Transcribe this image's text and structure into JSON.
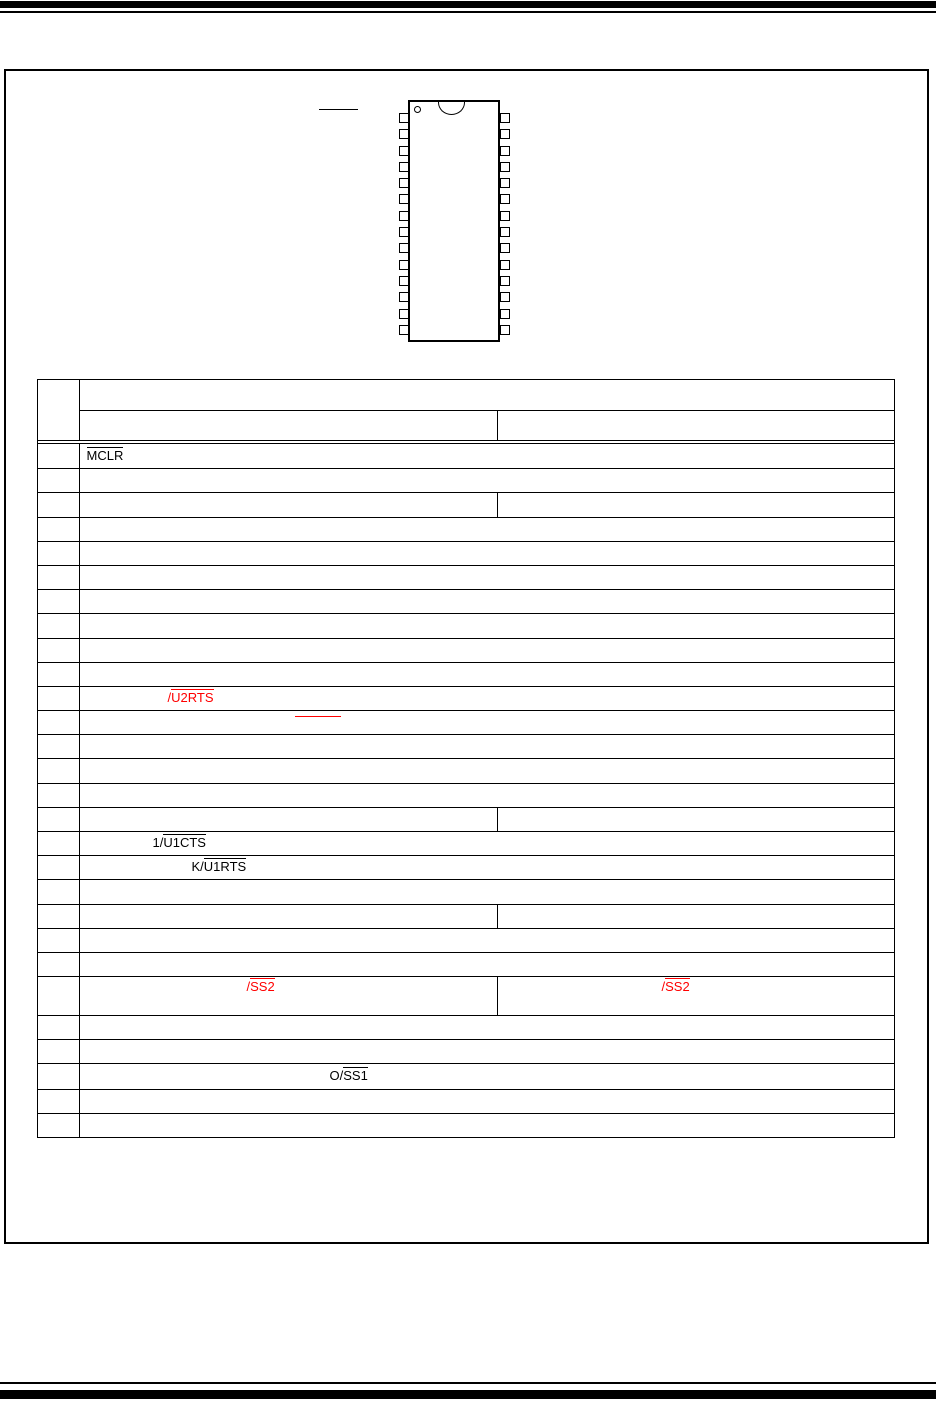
{
  "colors": {
    "line_black": "#000000",
    "highlight_red": "#ff0000",
    "page_background": "#ffffff"
  },
  "chip": {
    "package_pin_count": 28,
    "pins_per_side": 14
  },
  "pin_table": {
    "labels": {
      "mclr": {
        "pre": "",
        "over": "MCLR"
      },
      "u2rts": {
        "pre": "/",
        "over": "U2RTS"
      },
      "u1cts": {
        "pre": "1/",
        "over": "U1CTS"
      },
      "u1rts": {
        "pre": "K/",
        "over": "U1RTS"
      },
      "ss2_left": {
        "pre": "/",
        "over": "SS2"
      },
      "ss2_right": {
        "pre": "/",
        "over": "SS2"
      },
      "ss1": {
        "pre": "O/",
        "over": "SS1"
      }
    }
  }
}
